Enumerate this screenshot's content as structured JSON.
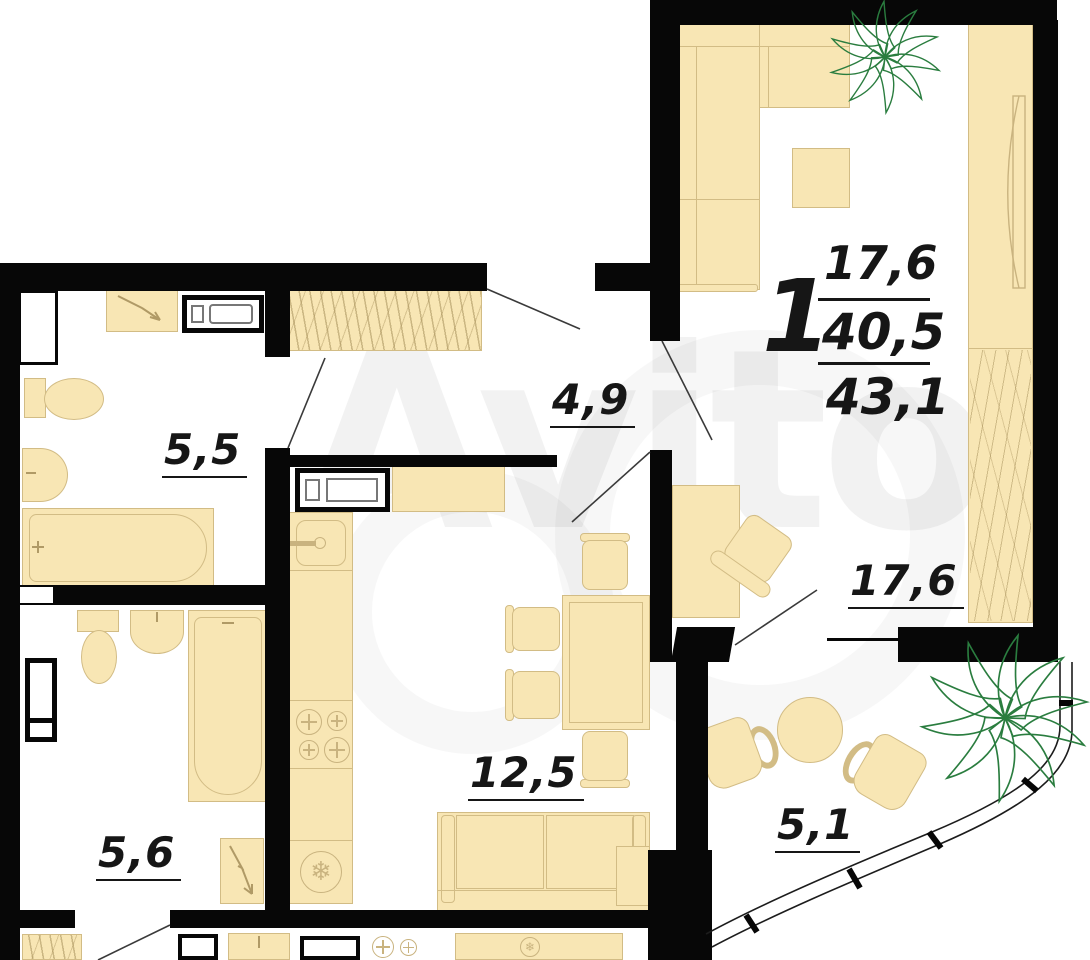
{
  "plan": {
    "watermark": "Avito",
    "summary": {
      "rooms_count": "1",
      "living_area": "17,6",
      "area_no_balcony": "40,5",
      "total_area": "43,1"
    },
    "rooms": {
      "bathroom_top": {
        "area": "5,5"
      },
      "hallway": {
        "area": "4,9"
      },
      "kitchen": {
        "area": "12,5"
      },
      "living_room": {
        "area": "17,6"
      },
      "bathroom_bottom": {
        "area": "5,6"
      },
      "balcony": {
        "area": "5,1"
      }
    },
    "colors": {
      "wall": "#070707",
      "furniture_fill": "#F8E6B4",
      "furniture_outline": "#D2BC85",
      "plant": "#2A7D3F",
      "label": "#161616"
    },
    "icons": {
      "snowflake": "❄"
    }
  }
}
